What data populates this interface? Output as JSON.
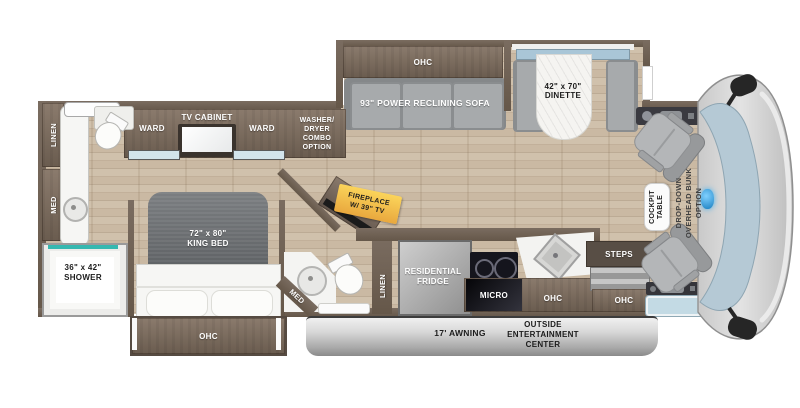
{
  "floorplan": {
    "bedroom": {
      "linen": "LINEN",
      "med": "MED",
      "ward_left": "WARD",
      "tv_cabinet": "TV CABINET",
      "ward_right": "WARD",
      "washer_dryer": [
        "WASHER/",
        "DRYER",
        "COMBO",
        "OPTION"
      ],
      "king_bed": [
        "72\" x 80\"",
        "KING BED"
      ],
      "shower": [
        "36\" x 42\"",
        "SHOWER"
      ],
      "ohc": "OHC"
    },
    "mid_bath": {
      "med": "MED",
      "linen": "LINEN"
    },
    "living": {
      "ohc": "OHC",
      "sofa": "93\" POWER RECLINING SOFA",
      "dinette": [
        "42\" x 70\"",
        "DINETTE"
      ],
      "fireplace": [
        "FIREPLACE",
        "W/ 39\" TV"
      ]
    },
    "kitchen": {
      "fridge": [
        "RESIDENTIAL",
        "FRIDGE"
      ],
      "micro": "MICRO",
      "ohc": "OHC",
      "steps": "STEPS",
      "entry_ohc": "OHC"
    },
    "cockpit": {
      "table": [
        "COCKPIT",
        "TABLE"
      ],
      "bunk": [
        "DROP-DOWN",
        "OVERHEAD BUNK",
        "OPTION"
      ]
    },
    "exterior": {
      "awning": "17' AWNING",
      "entertainment": [
        "OUTSIDE",
        "ENTERTAINMENT",
        "CENTER"
      ]
    },
    "colors": {
      "wall": "#6f6156",
      "floor": "#cbbaa5",
      "shower_accent": "#35b8b0",
      "fireplace_label": "#f6c84c",
      "windshield": "#b5c9d5"
    }
  }
}
